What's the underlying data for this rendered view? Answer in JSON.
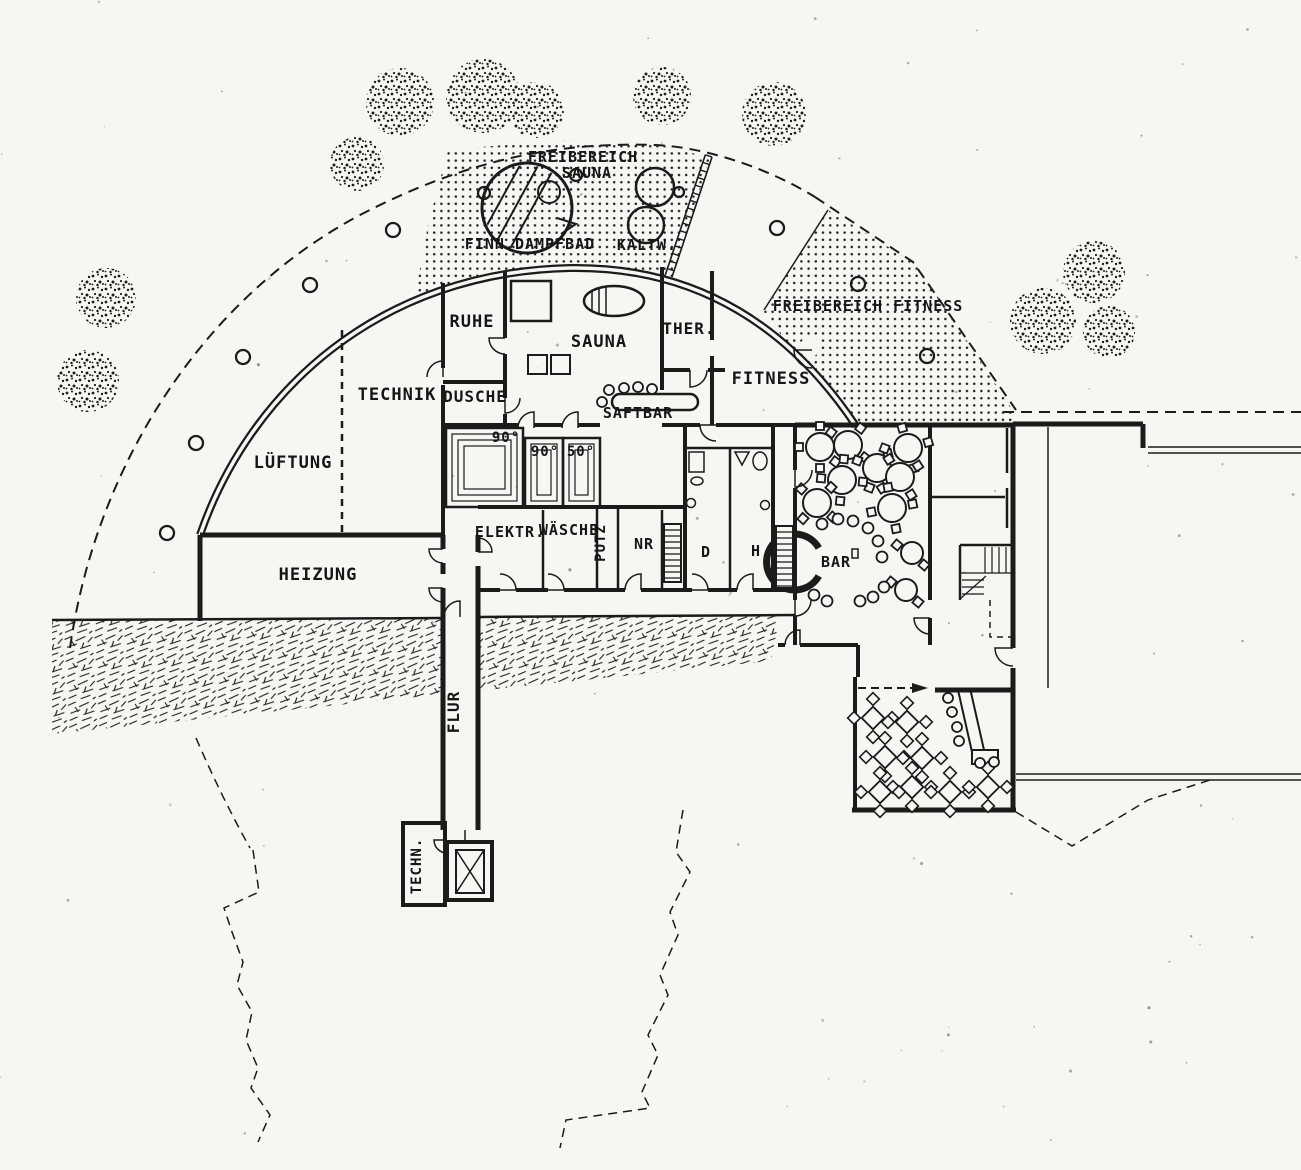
{
  "plan": {
    "outdoor": {
      "freibereich_sauna_1": "FREIBEREICH",
      "freibereich_sauna_2": "SAUNA",
      "finn_dampfbad": "FINN.DAMPFBAD",
      "kaltw": "KALTW.",
      "freibereich_fitness": "FREIBEREICH FITNESS"
    },
    "rooms": {
      "ruhe": "RUHE",
      "sauna": "SAUNA",
      "ther": "THER.",
      "fitness": "FITNESS",
      "technik": "TECHNIK",
      "dusche": "DUSCHE",
      "saftbar": "SAFTBAR",
      "lueftung": "LÜFTUNG",
      "heizung": "HEIZUNG",
      "elektr": "ELEKTR.",
      "waesche": "WÄSCHE",
      "putz": "PUTZ",
      "nr": "NR",
      "d": "D",
      "h": "H",
      "bar": "BAR",
      "flur": "FLUR",
      "techn": "TECHN."
    },
    "cabin_temps": {
      "c1": "90°",
      "c2": "90°",
      "c3": "50°"
    },
    "colors": {
      "ink": "#1b1b1b",
      "paper": "#f7f6f2"
    }
  }
}
